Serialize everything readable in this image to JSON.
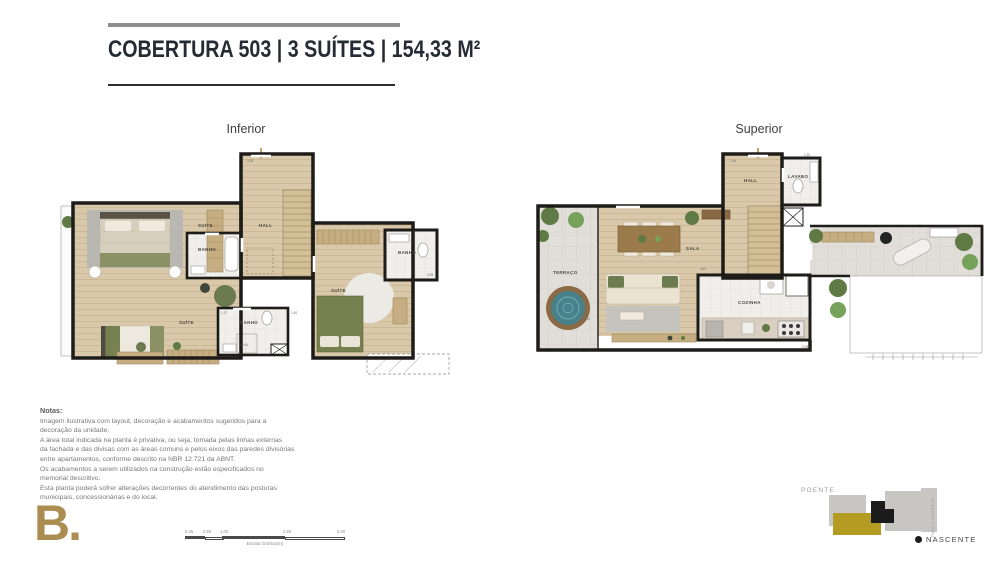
{
  "header": {
    "title": "COBERTURA 503 | 3 SUÍTES | 154,33 M²"
  },
  "plan_inferior": {
    "label": "Inferior",
    "rooms": {
      "suite_top": "SUÍTE",
      "hall": "HALL",
      "banho_top": "BANHO",
      "banho_right": "BANHO",
      "suite_right": "SUÍTE",
      "suite_bottom": "SUÍTE",
      "banho_bottom": "BANHO",
      "chuveiro": "CHU."
    },
    "dims": {
      "d1": "3,33",
      "d2": "1,40",
      "d3": "1,17",
      "d4": "3,05"
    }
  },
  "plan_superior": {
    "label": "Superior",
    "rooms": {
      "hall": "HALL",
      "lavabo": "LAVABO",
      "terraco": "TERRAÇO",
      "sala": "SALA",
      "cozinha": "COZINHA"
    },
    "dims": {
      "d1": "1,44",
      "d2": "1,20",
      "d3": "4,61",
      "d4": "3,31",
      "d5": "2,08"
    }
  },
  "notes": {
    "title": "Notas:",
    "lines": [
      "Imagem ilustrativa com layout, decoração e acabamentos sugeridos para a",
      "decoração da unidade.",
      "A área total indicada na planta é privativa, ou seja, tomada pelas linhas externas",
      "da fachada e das divisas com as áreas comuns e pelos eixos das paredes divisórias",
      "entre apartamentos, conforme descrito na NBR 12.721 da ABNT.",
      "Os acabamentos a serem utilizados na construção estão especificados no",
      "memorial descritivo.",
      "Esta planta poderá sofrer alterações decorrentes do atendimento das posturas",
      "municipais, concessionárias e do local."
    ]
  },
  "scalebar": {
    "ticks": [
      "0,25",
      "0,50",
      "1,00",
      "2,50",
      "5,00"
    ],
    "caption": "Escala Gráfica(m)"
  },
  "compass": {
    "poente": "POENTE",
    "nascente": "NASCENTE",
    "street": "PAULO BARRETO"
  },
  "logo": {
    "text": "B."
  },
  "colors": {
    "gold_logo": "#ab8d52",
    "gold_site": "#b49b22",
    "wall": "#1e1c19",
    "wood_floor": "#d9c9aa",
    "tile_floor": "#e1deda",
    "hot_tub_teal": "#47828c"
  }
}
